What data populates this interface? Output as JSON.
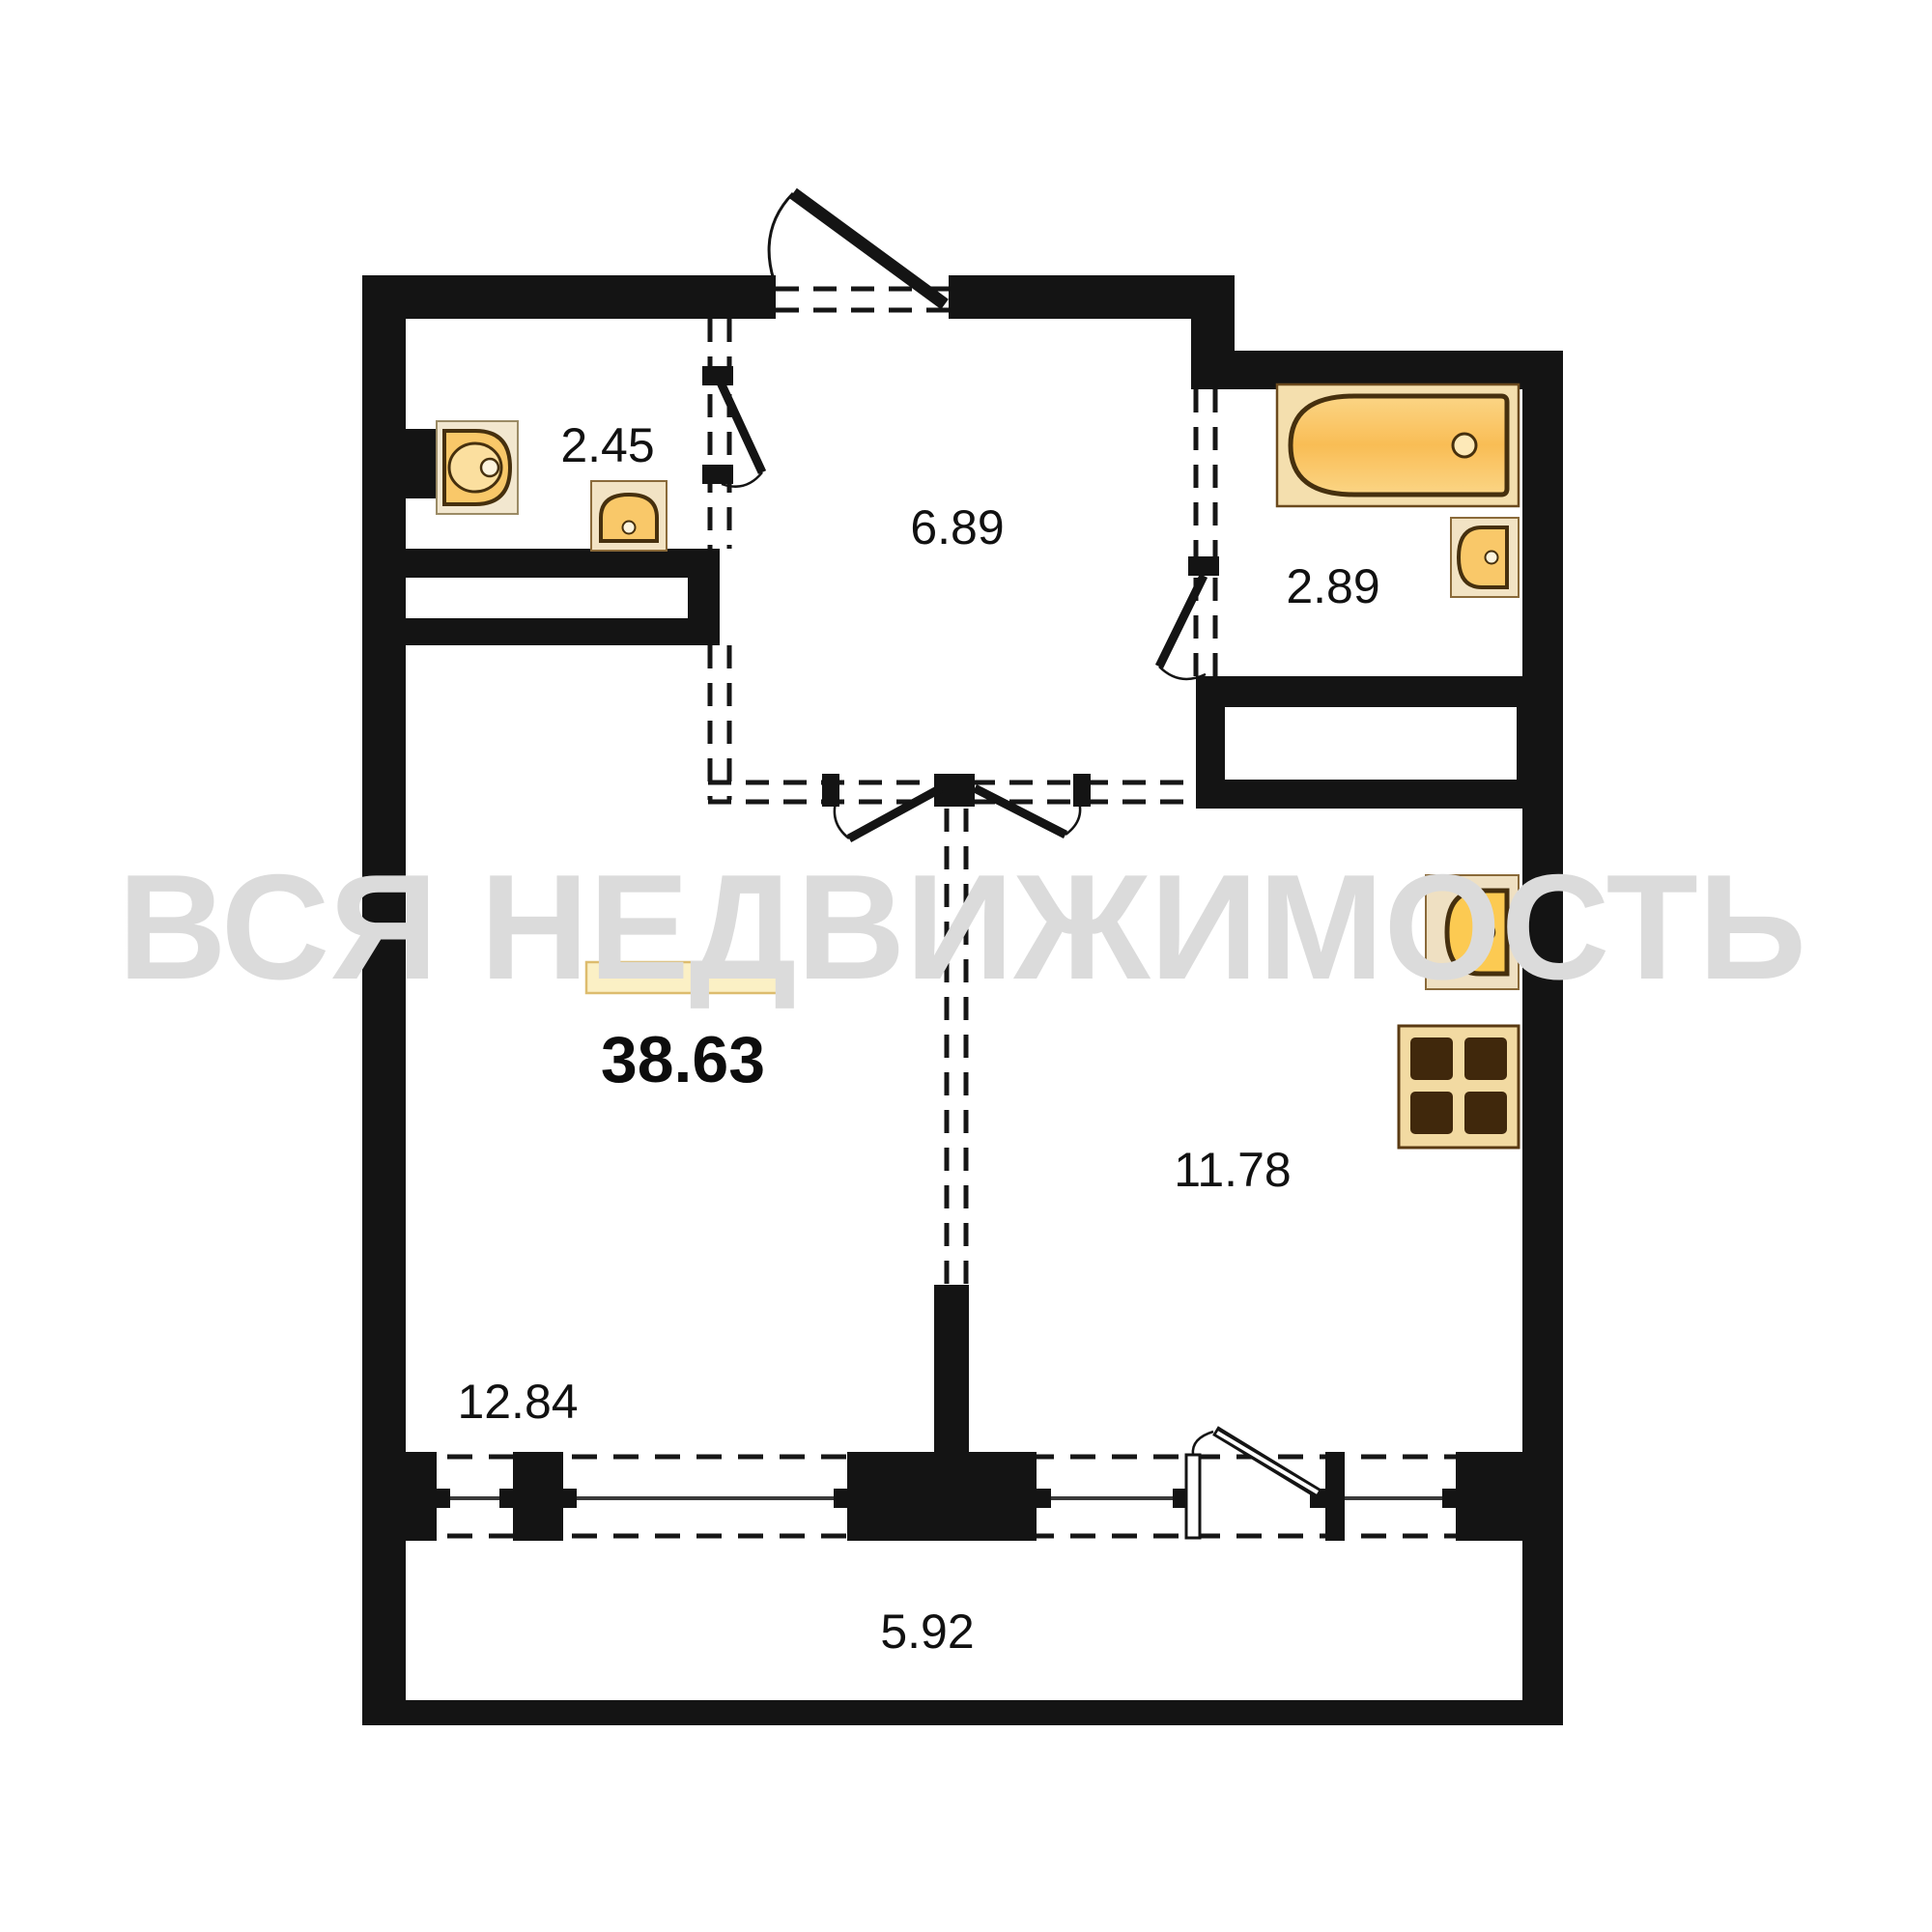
{
  "title": "Apartment floor plan 38.63 m²",
  "watermark": {
    "text": "ВСЯ НЕДВИЖИМОСТЬ",
    "color": "#dbdbdb"
  },
  "plan": {
    "total_area": "38.63",
    "rooms": [
      {
        "id": "wc",
        "area": "2.45"
      },
      {
        "id": "hallway",
        "area": "6.89"
      },
      {
        "id": "bathroom",
        "area": "2.89"
      },
      {
        "id": "kitchen",
        "area": "11.78"
      },
      {
        "id": "living-room",
        "area": "12.84"
      },
      {
        "id": "balcony",
        "area": "5.92"
      }
    ],
    "fixtures": [
      {
        "id": "toilet",
        "room": "wc"
      },
      {
        "id": "washbasin",
        "room": "wc"
      },
      {
        "id": "bathtub",
        "room": "bathroom"
      },
      {
        "id": "washbasin",
        "room": "bathroom"
      },
      {
        "id": "sink",
        "room": "kitchen"
      },
      {
        "id": "stove",
        "room": "kitchen"
      },
      {
        "id": "radiator",
        "room": "living-room"
      }
    ],
    "colors": {
      "wall": "#141414",
      "fixture_fill": "#f9c869",
      "fixture_outline": "#46300e",
      "fixture_backing": "#f2e3c4",
      "label": "#111111",
      "watermark": "#dbdbdb"
    }
  }
}
